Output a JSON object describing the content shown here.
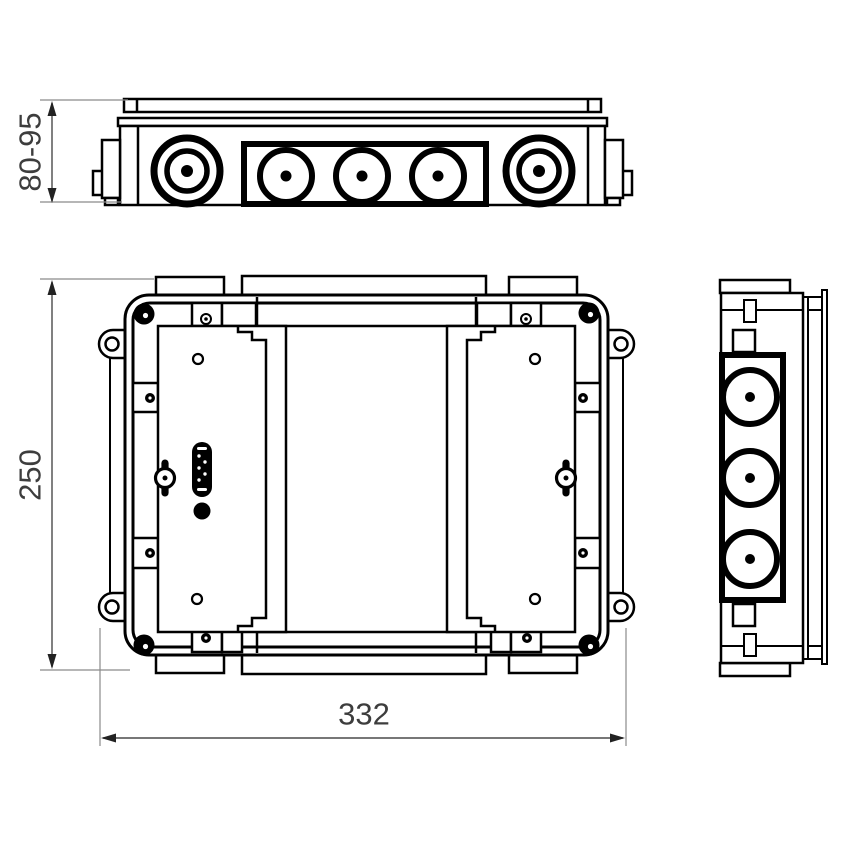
{
  "title": "Junction box technical drawing",
  "colors": {
    "line": "#000000",
    "dim_line": "#4a4a4a",
    "ext_line": "#8a8a8a",
    "text": "#3d3d3d",
    "background": "#ffffff"
  },
  "views": {
    "top": {
      "name": "top view",
      "large_knockouts": 2,
      "medium_knockouts": 3
    },
    "front": {
      "name": "front view",
      "cover_panels": 2,
      "mounting_ears": 4,
      "corner_screws": 4
    },
    "side": {
      "name": "side view",
      "knockouts": 3
    }
  },
  "dimensions": {
    "depth_range": {
      "label": "80-95"
    },
    "height": {
      "label": "250"
    },
    "width": {
      "label": "332"
    }
  }
}
